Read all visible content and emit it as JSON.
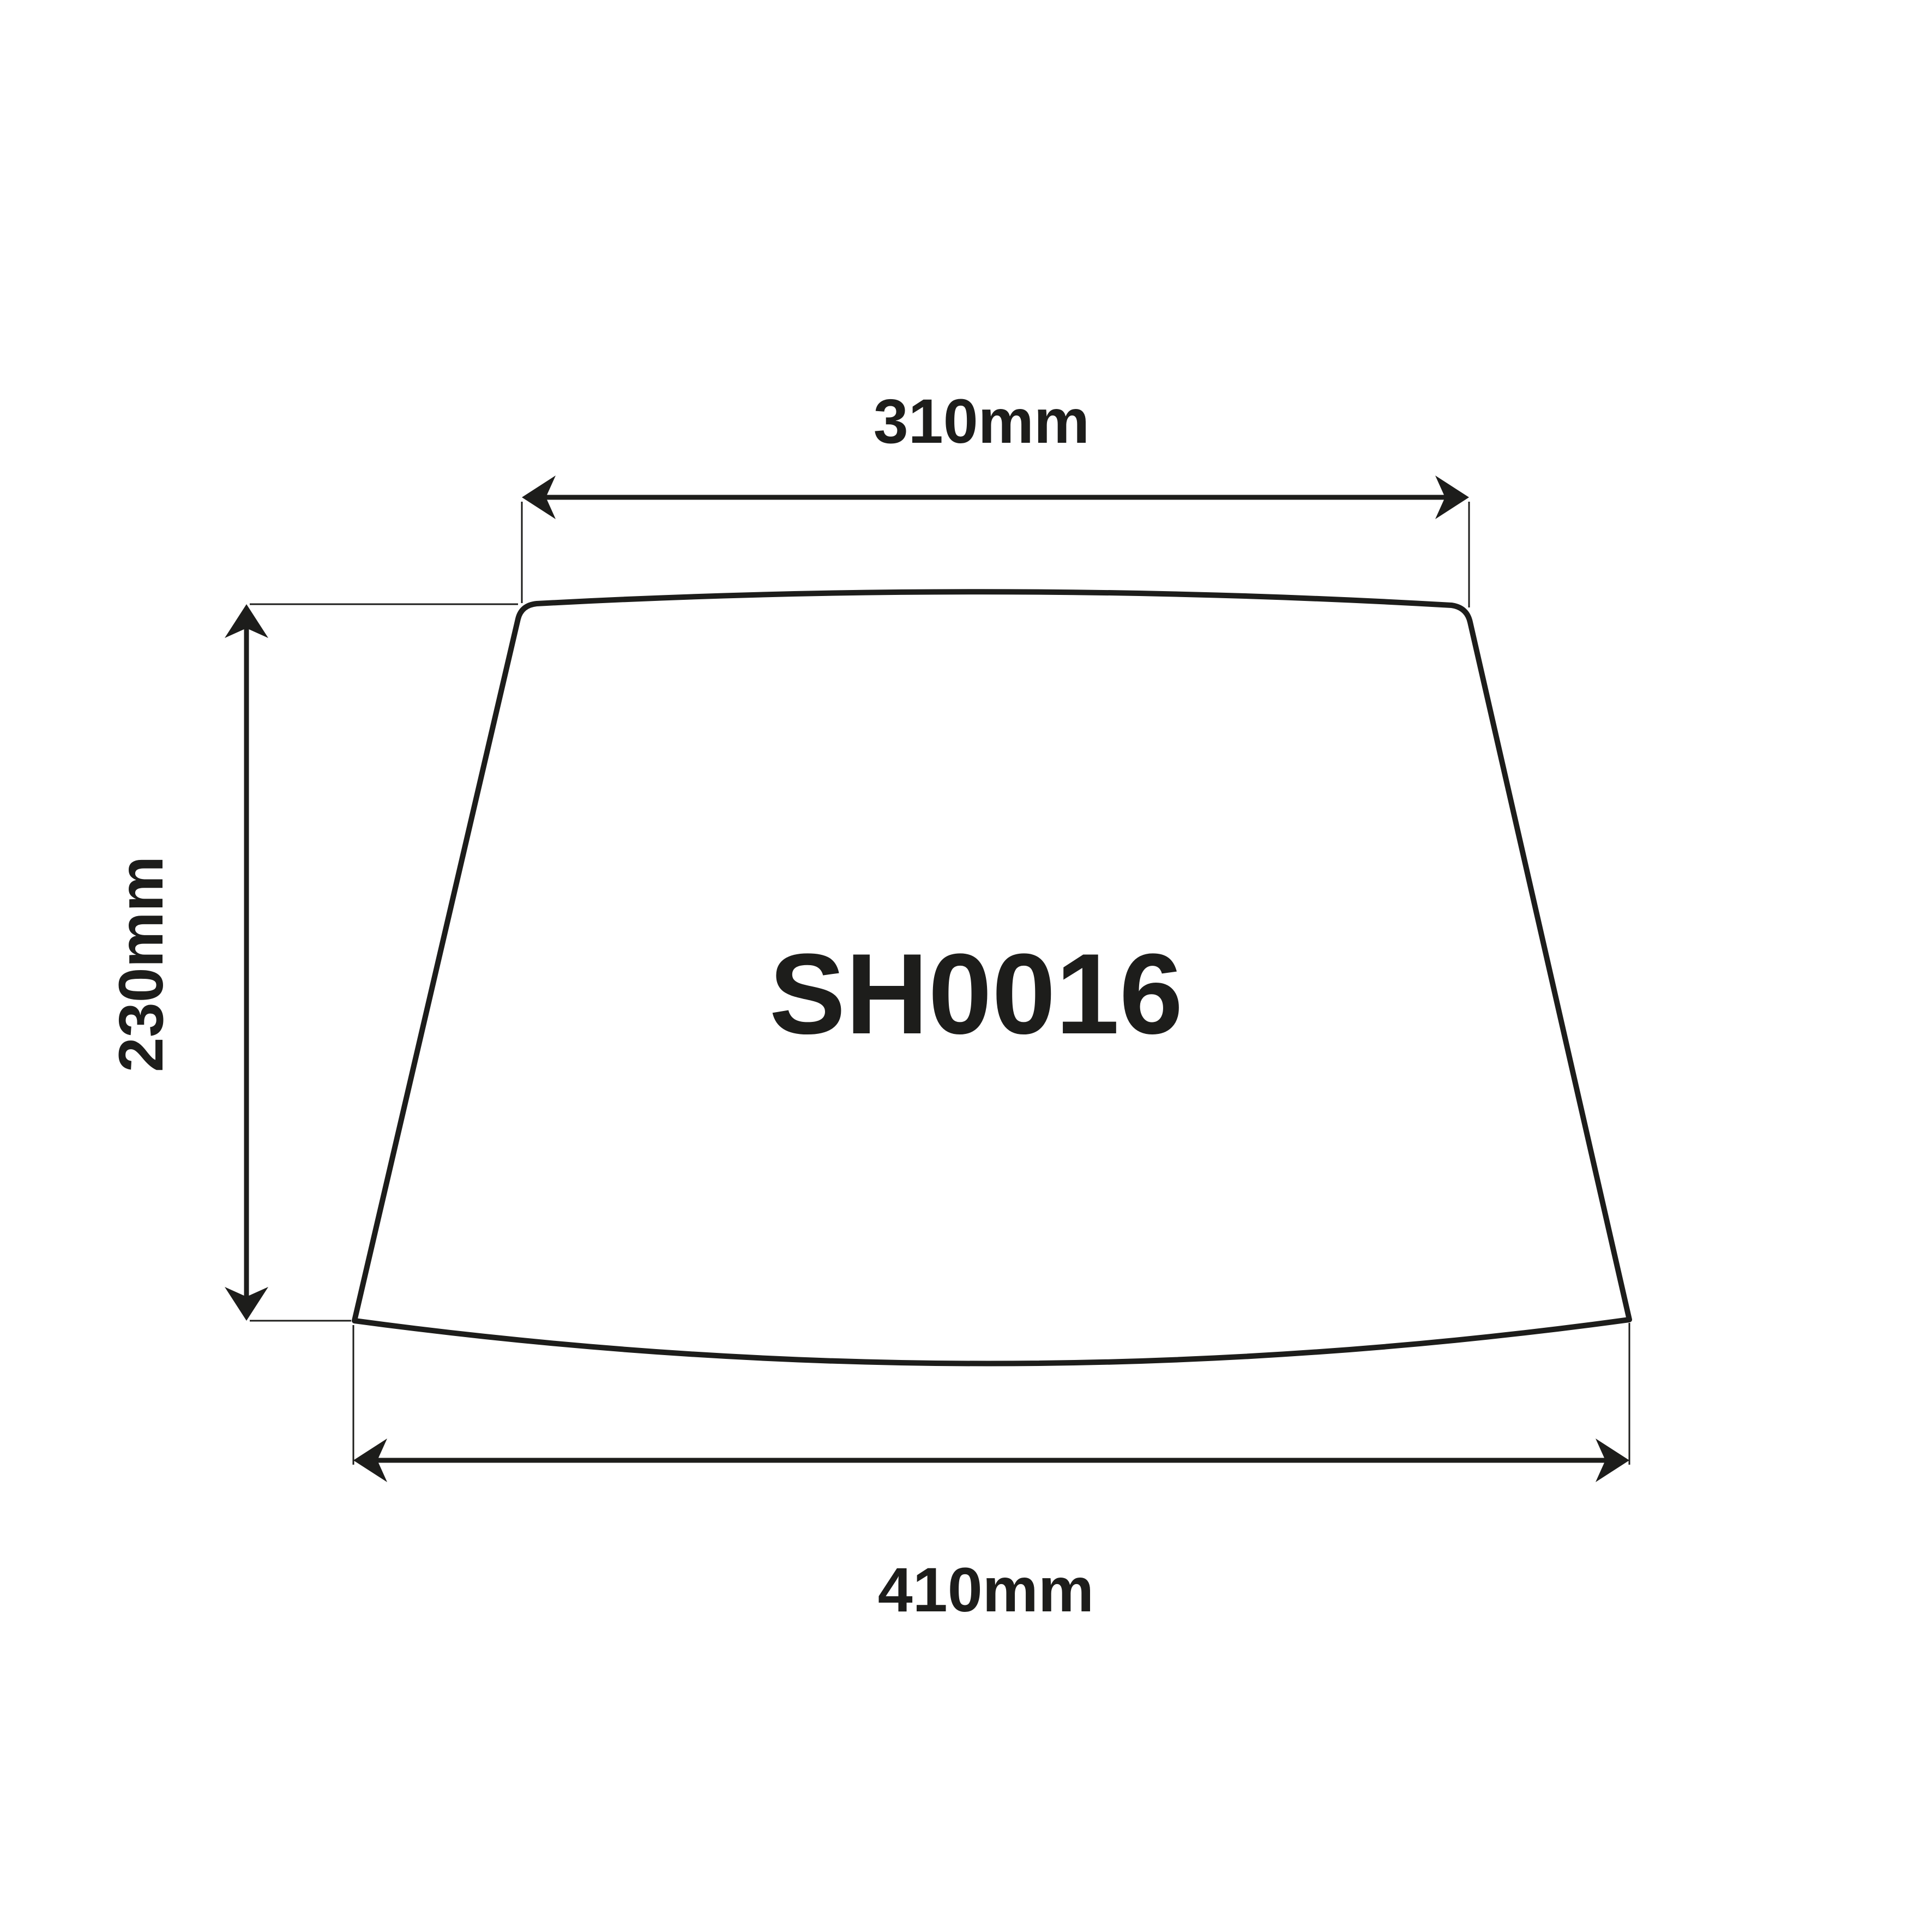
{
  "diagram": {
    "part_number": "SH0016",
    "dimensions": {
      "top_width": "310mm",
      "side_height": "230mm",
      "bottom_width": "410mm"
    },
    "colors": {
      "background": "#ffffff",
      "line": "#1d1d1b",
      "text": "#1d1d1b"
    }
  }
}
